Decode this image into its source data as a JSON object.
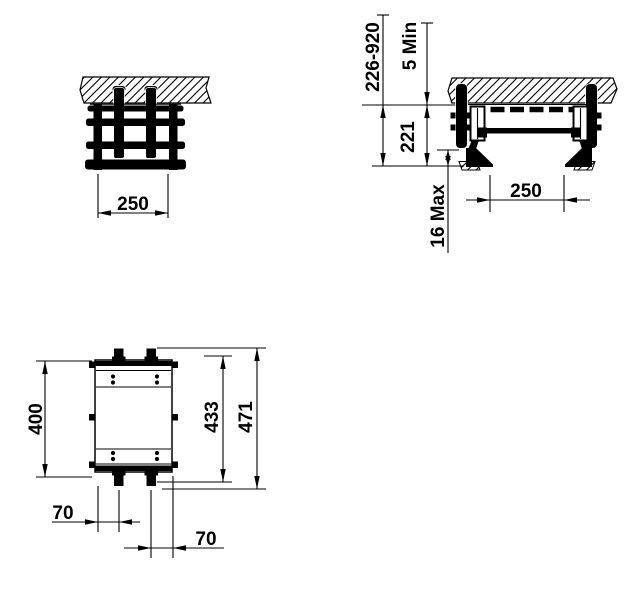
{
  "title": "shower-seat-installation-dimension-drawing",
  "colors": {
    "ink": "#000000",
    "paper": "#ffffff"
  },
  "views": {
    "front": {
      "width": "250"
    },
    "side": {
      "mount_height_range": "226-920",
      "top_clearance": "5 Min",
      "frame_height": "221",
      "floor_clearance": "16 Max",
      "depth": "250"
    },
    "plan": {
      "frame_length": "400",
      "plate_length": "433",
      "overall_length": "471",
      "peg_offset_front": "70",
      "peg_offset_rear": "70"
    }
  }
}
